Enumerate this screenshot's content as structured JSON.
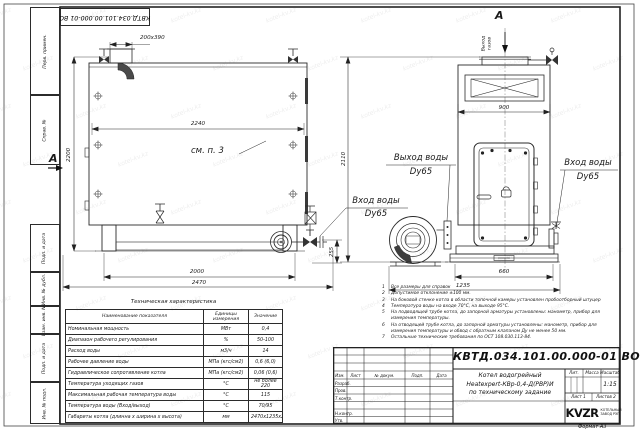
{
  "watermark": {
    "text": "kotel-kv.kz"
  },
  "stamp_top": "КВТД.034.101.00.000-01 ВО",
  "margin_fields": {
    "perv": "Перв. примен.",
    "sprav": "Справ. №",
    "podp1": "Подп. и дата",
    "inv_dubl": "Инв. № дубл.",
    "vzam": "Взам. инв. №",
    "podp2": "Подп. и дата",
    "inv_podl": "Инв. № подл."
  },
  "views": {
    "front": {
      "dim_chimney": "200х390",
      "dim_width_inner": "2240",
      "dim_height": "2200",
      "see_note": "см. п. 3",
      "section_label": "А",
      "dim_legs": "2000",
      "dim_length": "2470",
      "dim_255": "255",
      "inlet_line1": "Вход воды",
      "inlet_line2": "Dy65"
    },
    "side": {
      "view_label": "А",
      "gas_out_line1": "Выход",
      "gas_out_line2": "газов",
      "dim_width": "900",
      "dim_height": "2110",
      "dim_base": "660",
      "dim_depth": "1235",
      "outlet_line1": "Выход воды",
      "outlet_line2": "Dy65",
      "inlet_line1": "Вход воды",
      "inlet_line2": "Dy65"
    }
  },
  "tech_table": {
    "title": "Техническая характеристика",
    "headers": [
      "Наименование показателя",
      "Единицы измерения",
      "Значение"
    ],
    "rows": [
      {
        "name": "Номинальная мощность",
        "unit": "МВт",
        "value": "0,4"
      },
      {
        "name": "Диапазон рабочего регулирования",
        "unit": "%",
        "value": "50-100"
      },
      {
        "name": "Расход воды",
        "unit": "м3/ч",
        "value": "14"
      },
      {
        "name": "Рабочее давление воды",
        "unit": "МПа (кгс/см2)",
        "value": "0,6 (6,0)"
      },
      {
        "name": "Гидравлическое сопротивление котла",
        "unit": "МПа (кгс/см2)",
        "value": "0,06 (0,6)"
      },
      {
        "name": "Температура уходящих газов",
        "unit": "°С",
        "value": "не более 220"
      },
      {
        "name": "Максимальная рабочая температура воды",
        "unit": "°С",
        "value": "115"
      },
      {
        "name": "Температура воды (Вход/выход)",
        "unit": "°С",
        "value": "70/95"
      },
      {
        "name": "Габариты котла (длинна х ширина х высота)",
        "unit": "мм",
        "value": "2470х1235х2200"
      }
    ]
  },
  "notes": [
    {
      "n": "1",
      "text": "Все размеры для справок"
    },
    {
      "n": "2",
      "text": "Допустимое отклонение ±100 мм."
    },
    {
      "n": "3",
      "text": "На боковой стенке котла в области топочной камеры установлен пробоотборный штуцер"
    },
    {
      "n": "4",
      "text": "Температура воды на входе 70°С, на выходе 95°С."
    },
    {
      "n": "5",
      "text": "На подводящей трубе котла, до запорной арматуры установлены: манометр, прибор для измерения температуры."
    },
    {
      "n": "6",
      "text": "На отводящей трубе котла, до запорной арматуры установлены: манометр, прибор для измерения температуры и обвод с обратным клапаном Ду не менее 50 мм."
    },
    {
      "n": "7",
      "text": "Остальные технические требования по ОСТ 108.030.113-84."
    }
  ],
  "title_block": {
    "designation": "КВТД.034.101.00.000-01 ВО",
    "name_line1": "Котел водогрейный",
    "name_line2": "Heatexpert-КВр-0,4-Д(РВР)И",
    "name_line3": "по техническому задание",
    "lit_label": "Лит.",
    "mass_label": "Масса",
    "scale_label": "Масштаб",
    "scale": "1:15",
    "sheet_label": "Лист",
    "sheet_num": "1",
    "sheets_label": "Листов",
    "sheets_num": "2",
    "col_izm": "Изм.",
    "col_list": "Лист",
    "col_doc": "№ докум.",
    "col_podp": "Подп.",
    "col_data": "Дата",
    "row_razrab": "Разраб.",
    "row_prov": "Пров.",
    "row_tkontr": "Т.контр.",
    "row_nkontr": "Н.контр.",
    "row_utv": "Утв.",
    "logo": "KVZR",
    "logo_sub1": "КОТЕЛЬНЫЙ",
    "logo_sub2": "ЗАВОД РЭП",
    "format": "Формат  А3"
  }
}
